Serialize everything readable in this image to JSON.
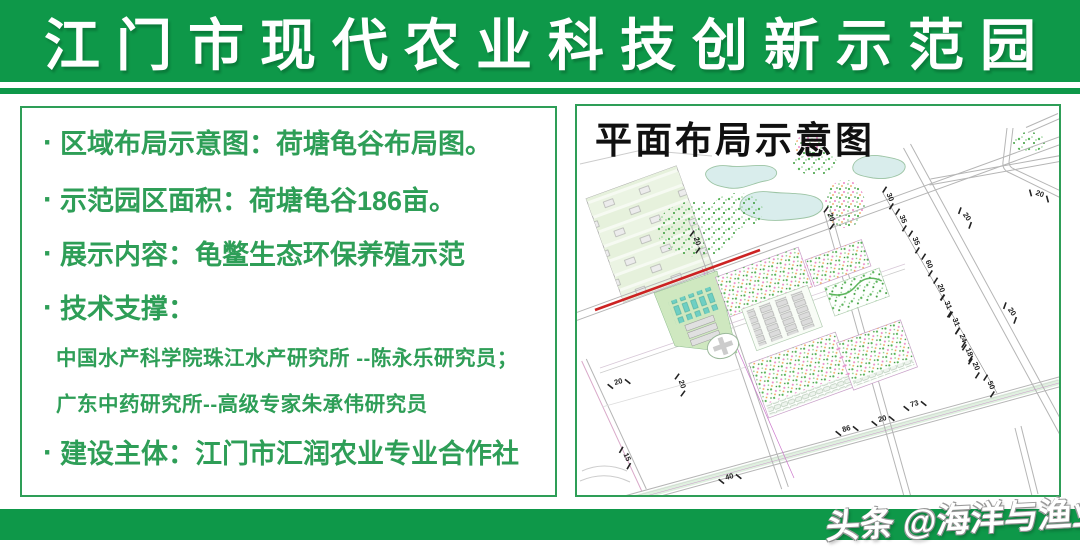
{
  "header": {
    "title": "江门市现代农业科技创新示范园"
  },
  "info_panel": {
    "bullet_char": "·",
    "items": [
      {
        "bullet": true,
        "size": "large",
        "text": "区域布局示意图：荷塘龟谷布局图。"
      },
      {
        "bullet": true,
        "size": "large",
        "text": "示范园区面积：荷塘龟谷186亩。"
      },
      {
        "bullet": true,
        "size": "large",
        "text": "展示内容：龟鳖生态环保养殖示范"
      },
      {
        "bullet": true,
        "size": "large",
        "text": "技术支撑："
      },
      {
        "bullet": false,
        "size": "small",
        "text": "中国水产科学院珠江水产研究所 --陈永乐研究员；"
      },
      {
        "bullet": false,
        "size": "small",
        "text": "广东中药研究所--高级专家朱承伟研究员"
      },
      {
        "bullet": true,
        "size": "large",
        "text": "建设主体：江门市汇润农业专业合作社"
      }
    ]
  },
  "plan_panel": {
    "title": "平面布局示意图",
    "dimension_labels": [
      {
        "t": "30",
        "x": 311,
        "y": 92,
        "r": 68
      },
      {
        "t": "35",
        "x": 324,
        "y": 114,
        "r": 68
      },
      {
        "t": "35",
        "x": 337,
        "y": 136,
        "r": 68
      },
      {
        "t": "60",
        "x": 350,
        "y": 159,
        "r": 68
      },
      {
        "t": "20",
        "x": 362,
        "y": 183,
        "r": 68
      },
      {
        "t": "31",
        "x": 369,
        "y": 200,
        "r": 68
      },
      {
        "t": "31",
        "x": 377,
        "y": 217,
        "r": 68
      },
      {
        "t": "24",
        "x": 384,
        "y": 233,
        "r": 68
      },
      {
        "t": "18",
        "x": 390,
        "y": 247,
        "r": 68
      },
      {
        "t": "20",
        "x": 397,
        "y": 261,
        "r": 68
      },
      {
        "t": "50",
        "x": 412,
        "y": 280,
        "r": 68
      },
      {
        "t": "20",
        "x": 118,
        "y": 136,
        "r": 71
      },
      {
        "t": "20",
        "x": 252,
        "y": 112,
        "r": 71
      },
      {
        "t": "20",
        "x": 388,
        "y": 112,
        "r": 55
      },
      {
        "t": "20",
        "x": 462,
        "y": 90,
        "r": 20
      },
      {
        "t": "20",
        "x": 433,
        "y": 207,
        "r": 55
      },
      {
        "t": "86",
        "x": 270,
        "y": 325,
        "r": -16
      },
      {
        "t": "20",
        "x": 306,
        "y": 315,
        "r": -16
      },
      {
        "t": "73",
        "x": 338,
        "y": 300,
        "r": -16
      },
      {
        "t": "40",
        "x": 153,
        "y": 373,
        "r": -16
      },
      {
        "t": "15",
        "x": 48,
        "y": 352,
        "r": 65
      },
      {
        "t": "20",
        "x": 42,
        "y": 278,
        "r": -16
      },
      {
        "t": "20",
        "x": 103,
        "y": 279,
        "r": 71
      }
    ]
  },
  "watermark": {
    "text": "头条 @海洋与渔业"
  },
  "colors": {
    "band_green": "#0e9849",
    "text_green": "#2e9e57",
    "red_line": "#cc2222",
    "pond_fill": "#d9edec"
  }
}
